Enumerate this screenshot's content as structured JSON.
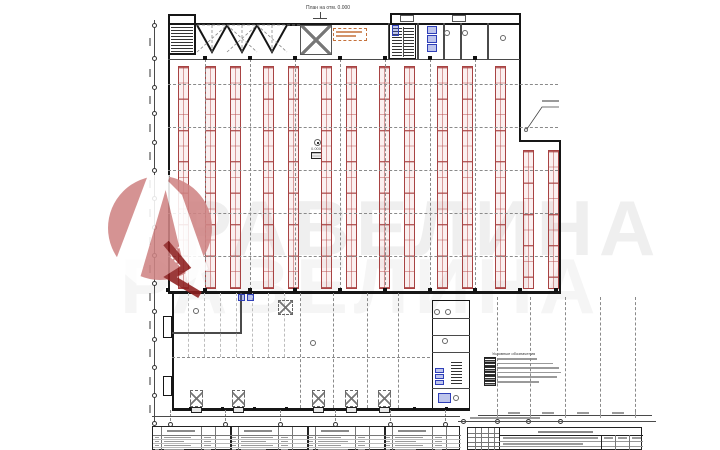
{
  "title": {
    "plan_label": "План на отм. 0.000"
  },
  "annotations": {
    "mid_hall_marker_value": "0.000",
    "legend_title": "Условные обозначения",
    "legend_row_widths": [
      40,
      56,
      62,
      64,
      60,
      42
    ]
  },
  "watermark": {
    "approx_text": "РАВЕЛИНА",
    "logo_name": "red-circle-letter-A-logo"
  },
  "colors": {
    "wall": "#161616",
    "rack": "#b54545",
    "rack_dark": "#8e2f2f",
    "grid": "#8a8a8a",
    "blue_fixture": "#2f3fb8",
    "orange_note": "#c4703a",
    "watermark_pink": "#d08585",
    "watermark_red": "#8e1f1f",
    "micro_text": "#9a9a9a"
  },
  "racks": {
    "strip_width": 11,
    "cell_height": 15.7,
    "full": {
      "y_top": 66,
      "y_bottom": 289,
      "x": [
        178,
        205,
        230,
        263,
        288,
        321,
        346,
        379,
        404,
        437,
        462,
        495
      ]
    },
    "partial": {
      "y_top": 150,
      "y_bottom": 289,
      "x": [
        523,
        548
      ]
    }
  },
  "grid": {
    "hall_v": {
      "x": [
        205,
        250,
        295,
        340,
        385,
        430,
        475
      ],
      "y1": 59,
      "y2": 290
    },
    "hall_h": {
      "y": [
        84,
        127,
        170,
        213,
        256
      ],
      "x1": 168,
      "x2": 558
    },
    "annex_v": {
      "x": [
        300,
        333,
        367,
        398
      ],
      "y1": 293,
      "y2": 408
    },
    "yard_v": {
      "x": [
        497,
        530,
        565,
        600,
        635
      ],
      "y1": 297,
      "y2": 412
    },
    "joists": {
      "x_start": 188,
      "step": 16,
      "count": 7,
      "y1": 293,
      "y2": 357
    },
    "annex_h_y": 357,
    "left_chain": {
      "x": 154,
      "y1": 20,
      "y2": 425,
      "bubbles": [
        25,
        58,
        87,
        113,
        142,
        170,
        198,
        227,
        255,
        283,
        311,
        339,
        367,
        395,
        423
      ]
    },
    "bottom_bubbles": {
      "y": 424,
      "x": [
        170,
        225,
        280,
        335,
        390,
        445
      ]
    },
    "right_bubbles": {
      "y": 421,
      "x": [
        463,
        497,
        528,
        560
      ],
      "line_x1": 458,
      "line_x2": 656
    }
  },
  "columns": {
    "top_y": 56,
    "top_x": [
      205,
      250,
      295,
      340,
      385,
      430,
      475
    ],
    "bottom_y": 288,
    "bottom_x": [
      168,
      205,
      250,
      295,
      340,
      385,
      430,
      475,
      520,
      556
    ],
    "annex_y": 407,
    "annex_x": [
      190,
      222,
      254,
      286,
      318,
      350,
      382,
      414,
      446
    ]
  },
  "docks": {
    "bottom": {
      "y": 390,
      "w": 13,
      "h": 17,
      "x": [
        190,
        232,
        312,
        345,
        378
      ]
    },
    "top_square": {
      "x": 278,
      "y": 300,
      "w": 15,
      "h": 15
    }
  },
  "fixtures": {
    "circles": [
      [
        447,
        33
      ],
      [
        465,
        33
      ],
      [
        503,
        38
      ],
      [
        196,
        311
      ],
      [
        313,
        343
      ],
      [
        437,
        312
      ],
      [
        448,
        312
      ],
      [
        445,
        341
      ],
      [
        456,
        398
      ]
    ]
  },
  "blue_elements": {
    "stalls": [
      [
        427,
        26
      ],
      [
        427,
        35
      ],
      [
        427,
        44
      ]
    ],
    "box": [
      392,
      25,
      7,
      11
    ],
    "annex_door": [
      [
        238,
        294
      ],
      [
        247,
        294
      ]
    ],
    "strip_cells": [
      [
        435,
        368
      ],
      [
        435,
        374
      ],
      [
        435,
        380
      ]
    ],
    "strip_box": [
      438,
      393,
      13,
      10
    ]
  },
  "tables": {
    "schedule": {
      "x": 152,
      "y": 426,
      "group_width": 77,
      "groups": 4,
      "col_offsets": [
        8,
        48,
        62
      ],
      "rows": 4
    },
    "titleblock": {
      "x": 467,
      "y": 427,
      "w": 175,
      "h": 23,
      "revision_cols": 4,
      "revision_rows": 4
    }
  }
}
